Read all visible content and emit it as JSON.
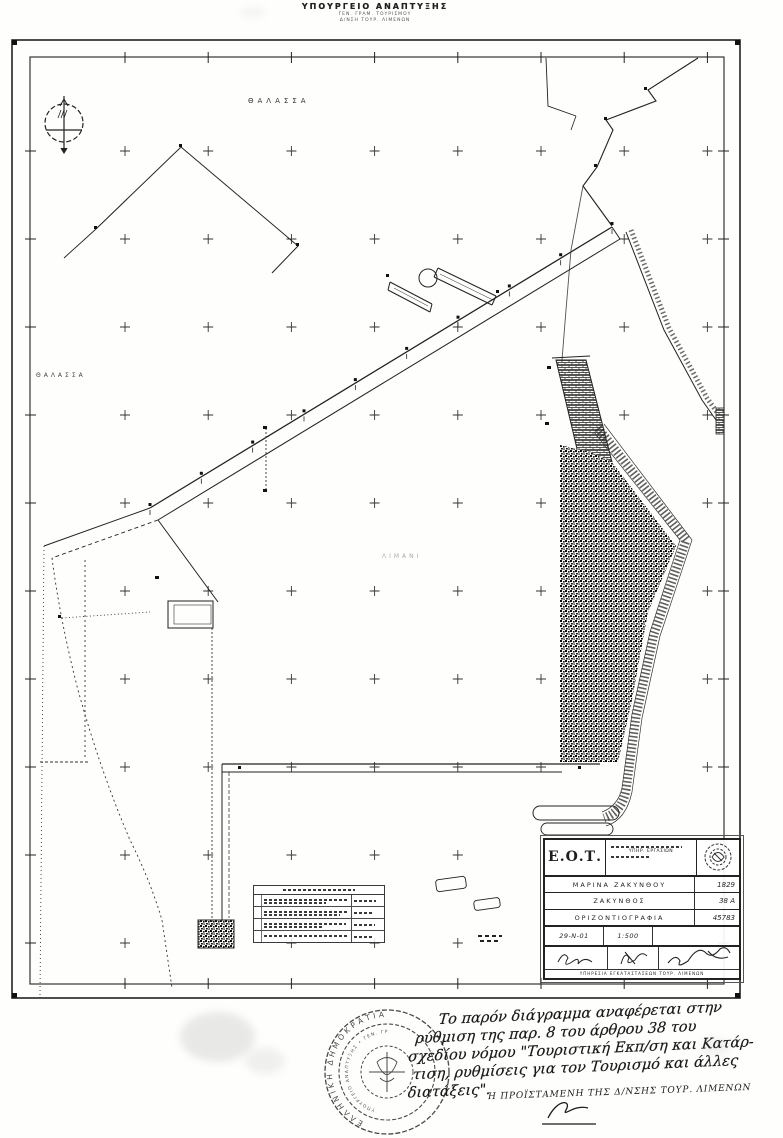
{
  "header": {
    "line1": "ΥΠΟΥΡΓΕΙΟ ΑΝΑΠΤΥΞΗΣ",
    "line2": "ΓΕΝ. ΓΡΑΜ. ΤΟΥΡΙΣΜΟΥ",
    "line3": "Δ/ΝΣΗ ΤΟΥΡ. ΛΙΜΕΝΩΝ"
  },
  "map": {
    "label_sea_top": "ΘΑΛΑΣΣΑ",
    "label_sea_left": "ΘΑΛΑΣΣΑ",
    "label_harbor": "ΛΙΜΑΝΙ"
  },
  "title_block": {
    "org": "Ε.Ο.Τ.",
    "dept": "ΥΠΗΡ. ΕΡΓΑΣΙΩΝ",
    "rows": [
      {
        "label": "ΜΑΡΙΝΑ ΖΑΚΥΝΘΟΥ",
        "value": "1829"
      },
      {
        "label": "ΖΑΚΥΝΘΟΣ",
        "value": "38 Α"
      },
      {
        "label": "ΟΡΙΖΟΝΤΙΟΓΡΑΦΙΑ",
        "value": "45783"
      }
    ],
    "date": "29-Ν-01",
    "scale": "1:500",
    "footer": "ΥΠΗΡΕΣΙΑ ΕΓΚΑΤΑΣΤΑΣΕΩΝ ΤΟΥΡ. ΛΙΜΕΝΩΝ"
  },
  "stamp": {
    "outer": "ΕΛΛΗΝΙΚΗ ΔΗΜΟΚΡΑΤΙΑ",
    "inner": "ΥΠΟΥΡΓΕΙΟ ΑΝΑΠΤΥΞΗΣ • ΓΕΝ. ΓΡΑΜ. ΤΟΥΡΙΣΜΟΥ"
  },
  "note": {
    "lines": [
      "Το παρόν διάγραμμα αναφέρεται στην",
      "ρύθμιση της παρ. 8 του άρθρου 38 του",
      "σχεδίου νόμου \"Τουριστική Εκπ/ση και Κατάρ-",
      "τιση, ρυθμίσεις για τον Τουρισμό και άλλες",
      "διατάξεις\"."
    ],
    "signoff": "Η ΠΡΟΪΣΤΑΜΕΝΗ ΤΗΣ Δ/ΝΣΗΣ ΤΟΥΡ. ΛΙΜΕΝΩΝ"
  },
  "colors": {
    "ink": "#1f1f1f",
    "paper": "#fefefd"
  }
}
